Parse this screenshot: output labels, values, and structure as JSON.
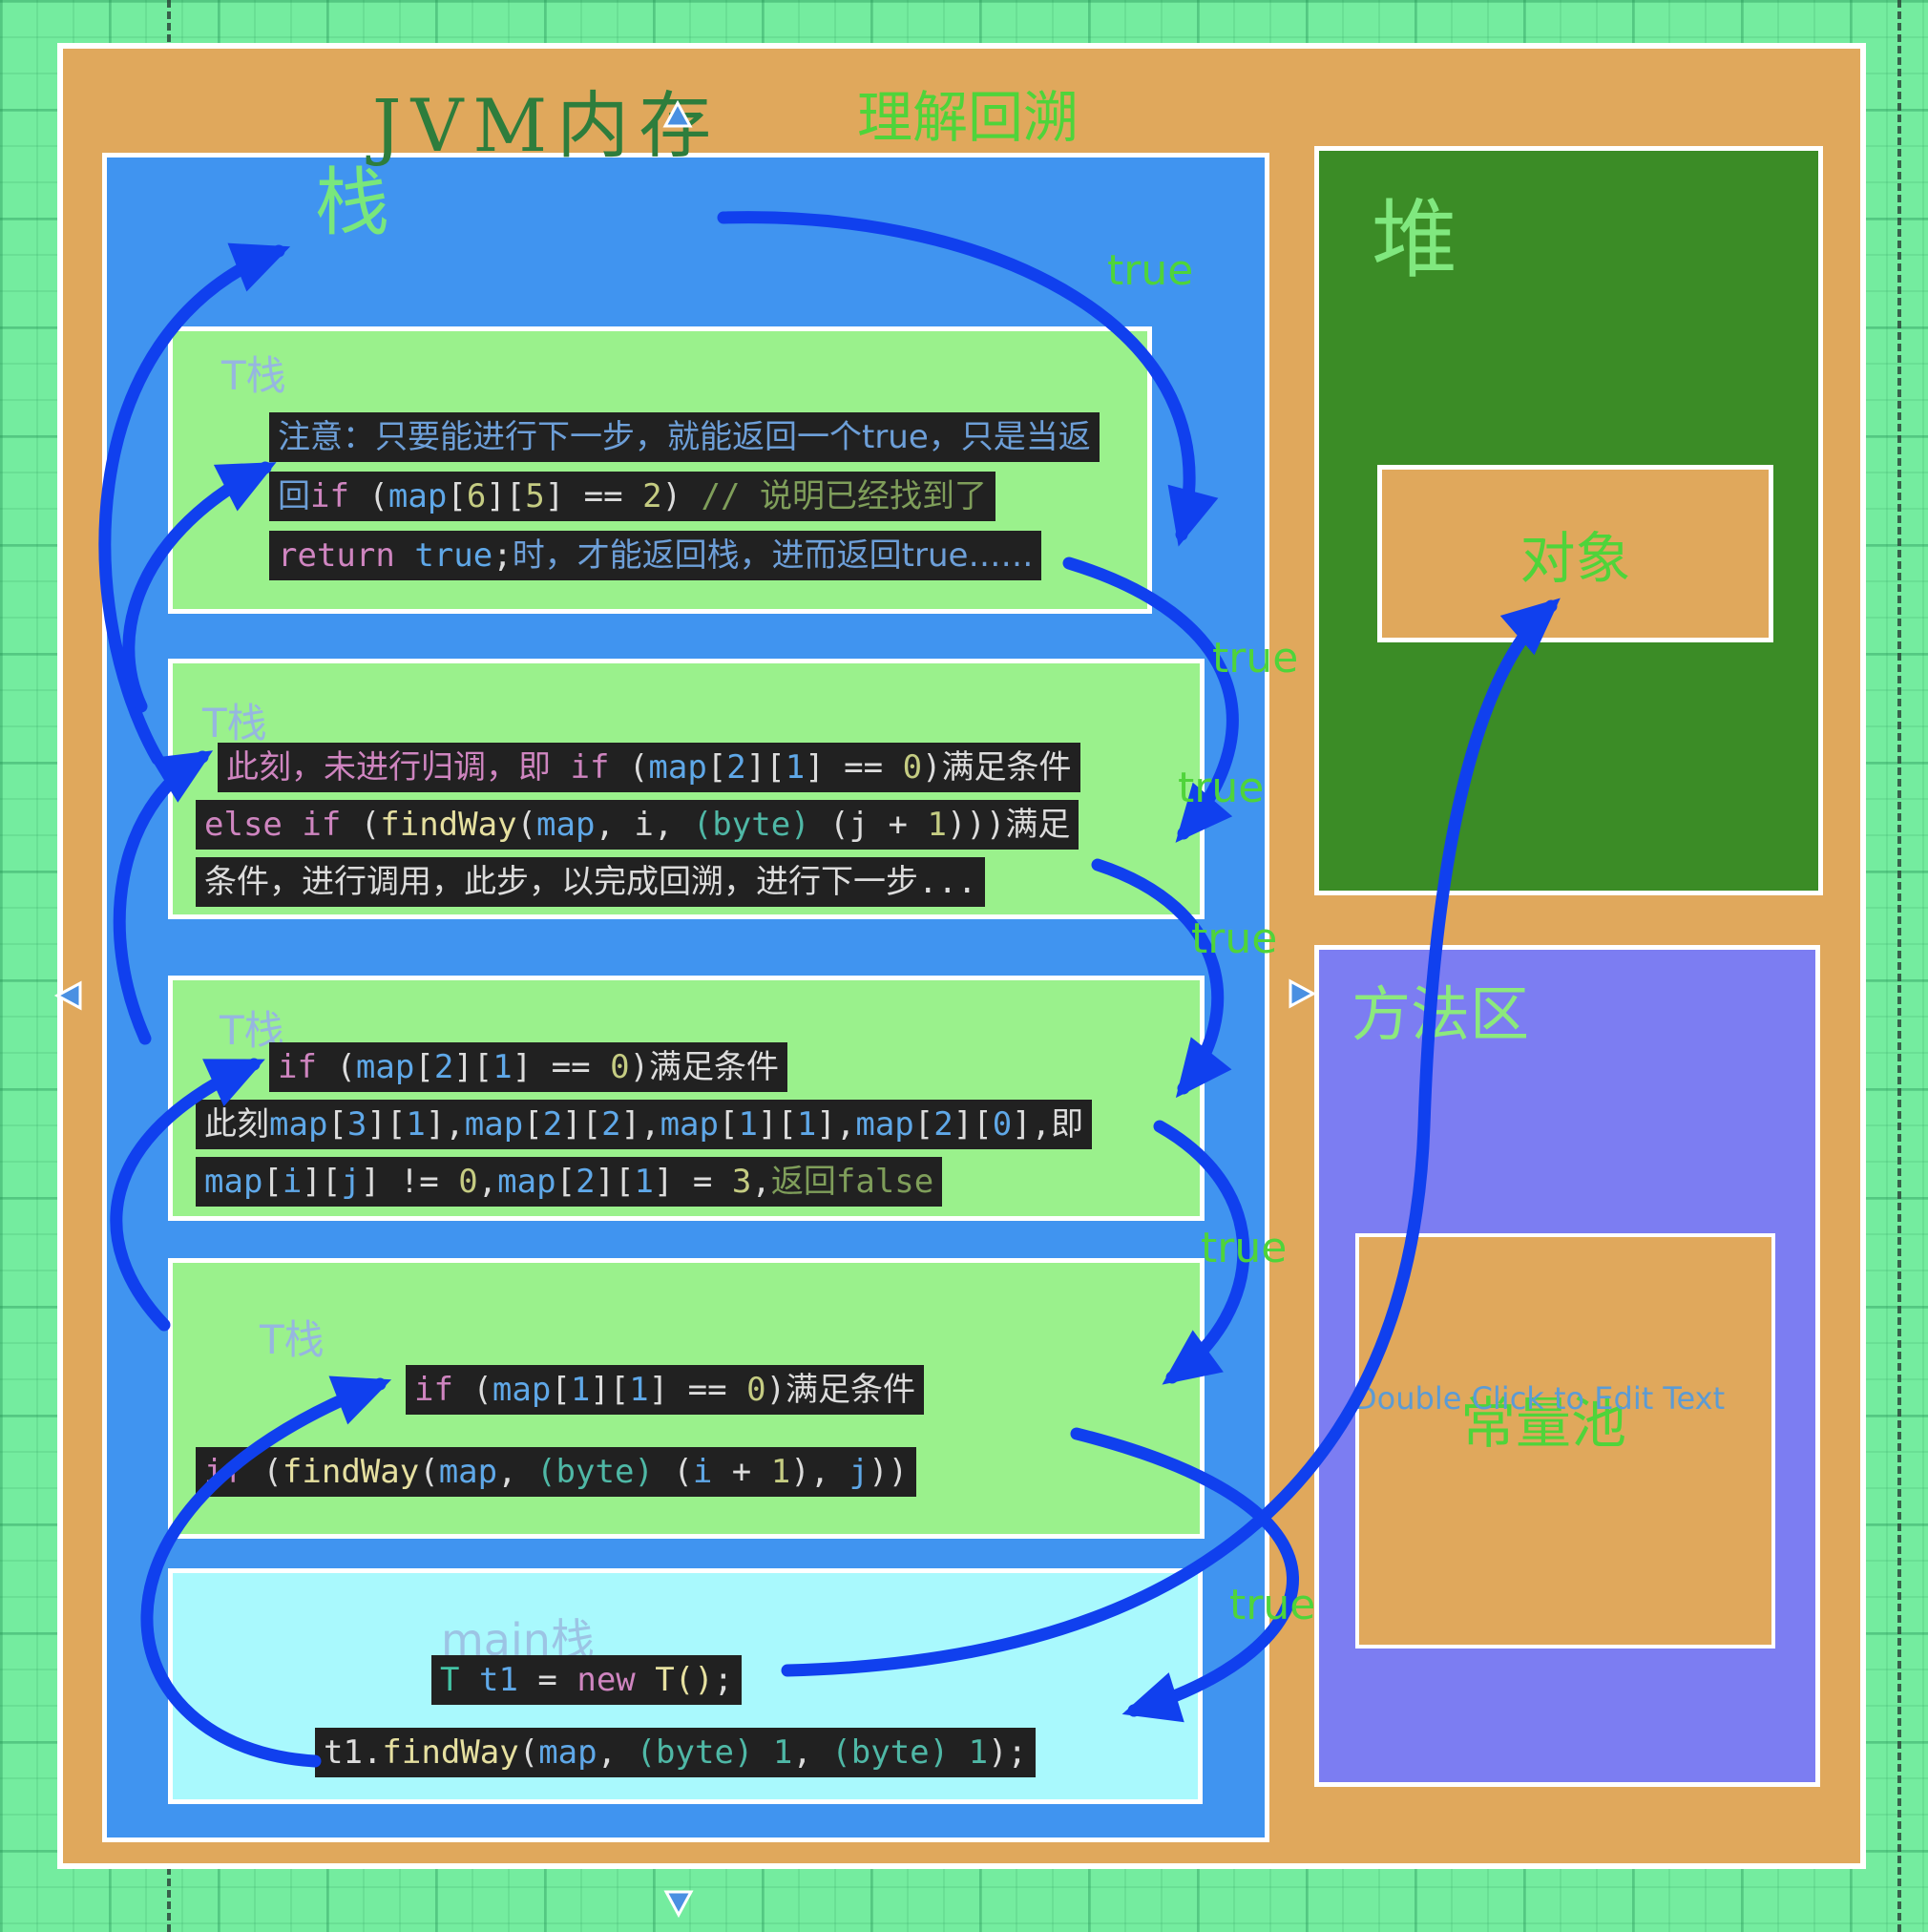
{
  "title": {
    "main": "JVM内存",
    "subtitle": "理解回溯"
  },
  "stack": {
    "label": "栈",
    "frames": [
      {
        "label": "T栈",
        "lines": [
          [
            {
              "t": "zh",
              "s": "注意：只要能进行下一步，就能返回一个true，只是当返"
            }
          ],
          [
            {
              "t": "zh",
              "s": "回"
            },
            {
              "t": "kw",
              "s": "if"
            },
            {
              "t": "pl",
              "s": " ("
            },
            {
              "t": "id",
              "s": "map"
            },
            {
              "t": "pl",
              "s": "["
            },
            {
              "t": "num",
              "s": "6"
            },
            {
              "t": "pl",
              "s": "]["
            },
            {
              "t": "num",
              "s": "5"
            },
            {
              "t": "pl",
              "s": "] == "
            },
            {
              "t": "num",
              "s": "2"
            },
            {
              "t": "pl",
              "s": ") "
            },
            {
              "t": "com",
              "s": "// 说明已经找到了"
            }
          ],
          [
            {
              "t": "kw",
              "s": "return"
            },
            {
              "t": "pl",
              "s": " "
            },
            {
              "t": "id",
              "s": "true"
            },
            {
              "t": "pl",
              "s": ";"
            },
            {
              "t": "zh",
              "s": "时，才能返回栈，进而返回true……"
            }
          ]
        ]
      },
      {
        "label": "T栈",
        "lines": [
          [
            {
              "t": "kw",
              "s": "此刻，未进行归调，即 if"
            },
            {
              "t": "pl",
              "s": " ("
            },
            {
              "t": "id",
              "s": "map"
            },
            {
              "t": "pl",
              "s": "["
            },
            {
              "t": "id",
              "s": "2"
            },
            {
              "t": "pl",
              "s": "]["
            },
            {
              "t": "id",
              "s": "1"
            },
            {
              "t": "pl",
              "s": "] == "
            },
            {
              "t": "num",
              "s": "0"
            },
            {
              "t": "pl",
              "s": ")满足条件"
            }
          ],
          [
            {
              "t": "kw",
              "s": "else if"
            },
            {
              "t": "pl",
              "s": " ("
            },
            {
              "t": "fn",
              "s": "findWay"
            },
            {
              "t": "pl",
              "s": "("
            },
            {
              "t": "id",
              "s": "map"
            },
            {
              "t": "pl",
              "s": ", i, "
            },
            {
              "t": "byte",
              "s": "(byte)"
            },
            {
              "t": "pl",
              "s": " (j + "
            },
            {
              "t": "num",
              "s": "1"
            },
            {
              "t": "pl",
              "s": ")))满足"
            }
          ],
          [
            {
              "t": "pl",
              "s": "条件，进行调用，此步，以完成回溯，进行下一步..."
            }
          ]
        ]
      },
      {
        "label": "T栈",
        "lines": [
          [
            {
              "t": "kw",
              "s": "if"
            },
            {
              "t": "pl",
              "s": " ("
            },
            {
              "t": "id",
              "s": "map"
            },
            {
              "t": "pl",
              "s": "["
            },
            {
              "t": "id",
              "s": "2"
            },
            {
              "t": "pl",
              "s": "]["
            },
            {
              "t": "id",
              "s": "1"
            },
            {
              "t": "pl",
              "s": "] == "
            },
            {
              "t": "num",
              "s": "0"
            },
            {
              "t": "pl",
              "s": ")满足条件"
            }
          ],
          [
            {
              "t": "pl",
              "s": "此刻"
            },
            {
              "t": "id",
              "s": "map"
            },
            {
              "t": "pl",
              "s": "["
            },
            {
              "t": "id",
              "s": "3"
            },
            {
              "t": "pl",
              "s": "]["
            },
            {
              "t": "id",
              "s": "1"
            },
            {
              "t": "pl",
              "s": "],"
            },
            {
              "t": "id",
              "s": "map"
            },
            {
              "t": "pl",
              "s": "["
            },
            {
              "t": "id",
              "s": "2"
            },
            {
              "t": "pl",
              "s": "]["
            },
            {
              "t": "id",
              "s": "2"
            },
            {
              "t": "pl",
              "s": "],"
            },
            {
              "t": "id",
              "s": "map"
            },
            {
              "t": "pl",
              "s": "["
            },
            {
              "t": "id",
              "s": "1"
            },
            {
              "t": "pl",
              "s": "]["
            },
            {
              "t": "id",
              "s": "1"
            },
            {
              "t": "pl",
              "s": "],"
            },
            {
              "t": "id",
              "s": "map"
            },
            {
              "t": "pl",
              "s": "["
            },
            {
              "t": "id",
              "s": "2"
            },
            {
              "t": "pl",
              "s": "]["
            },
            {
              "t": "id",
              "s": "0"
            },
            {
              "t": "pl",
              "s": "],即"
            }
          ],
          [
            {
              "t": "id",
              "s": "map"
            },
            {
              "t": "pl",
              "s": "["
            },
            {
              "t": "id",
              "s": "i"
            },
            {
              "t": "pl",
              "s": "]["
            },
            {
              "t": "id",
              "s": "j"
            },
            {
              "t": "pl",
              "s": "] != "
            },
            {
              "t": "num",
              "s": "0"
            },
            {
              "t": "pl",
              "s": ","
            },
            {
              "t": "id",
              "s": "map"
            },
            {
              "t": "pl",
              "s": "["
            },
            {
              "t": "id",
              "s": "2"
            },
            {
              "t": "pl",
              "s": "]["
            },
            {
              "t": "id",
              "s": "1"
            },
            {
              "t": "pl",
              "s": "] = "
            },
            {
              "t": "num",
              "s": "3"
            },
            {
              "t": "pl",
              "s": ","
            },
            {
              "t": "com",
              "s": "返回false"
            }
          ]
        ]
      },
      {
        "label": "T栈",
        "lines": [
          [
            {
              "t": "kw",
              "s": "if"
            },
            {
              "t": "pl",
              "s": " ("
            },
            {
              "t": "id",
              "s": "map"
            },
            {
              "t": "pl",
              "s": "["
            },
            {
              "t": "id",
              "s": "1"
            },
            {
              "t": "pl",
              "s": "]["
            },
            {
              "t": "id",
              "s": "1"
            },
            {
              "t": "pl",
              "s": "] == "
            },
            {
              "t": "num",
              "s": "0"
            },
            {
              "t": "pl",
              "s": ")满足条件"
            }
          ],
          [
            {
              "t": "kw",
              "s": "if"
            },
            {
              "t": "pl",
              "s": " ("
            },
            {
              "t": "fn",
              "s": "findWay"
            },
            {
              "t": "pl",
              "s": "("
            },
            {
              "t": "id",
              "s": "map"
            },
            {
              "t": "pl",
              "s": ", "
            },
            {
              "t": "byte",
              "s": "(byte)"
            },
            {
              "t": "pl",
              "s": " ("
            },
            {
              "t": "id",
              "s": "i"
            },
            {
              "t": "pl",
              "s": " + "
            },
            {
              "t": "num",
              "s": "1"
            },
            {
              "t": "pl",
              "s": "), "
            },
            {
              "t": "id",
              "s": "j"
            },
            {
              "t": "pl",
              "s": "))"
            }
          ]
        ]
      }
    ],
    "main_frame": {
      "label": "main栈",
      "lines": [
        [
          {
            "t": "cls",
            "s": "T"
          },
          {
            "t": "pl",
            "s": " "
          },
          {
            "t": "id",
            "s": "t1"
          },
          {
            "t": "pl",
            "s": " = "
          },
          {
            "t": "kw",
            "s": "new"
          },
          {
            "t": "pl",
            "s": " "
          },
          {
            "t": "fn",
            "s": "T()"
          },
          {
            "t": "pl",
            "s": ";"
          }
        ],
        [
          {
            "t": "pl",
            "s": "t1."
          },
          {
            "t": "fn",
            "s": "findWay"
          },
          {
            "t": "pl",
            "s": "("
          },
          {
            "t": "id",
            "s": "map"
          },
          {
            "t": "pl",
            "s": ", "
          },
          {
            "t": "byte",
            "s": "(byte) 1"
          },
          {
            "t": "pl",
            "s": ", "
          },
          {
            "t": "byte",
            "s": "(byte) 1"
          },
          {
            "t": "pl",
            "s": ");"
          }
        ]
      ]
    }
  },
  "heap": {
    "label": "堆",
    "object_label": "对象"
  },
  "method_area": {
    "label": "方法区",
    "constant_pool_label": "常量池",
    "placeholder": "Double Click to Edit Text"
  },
  "arrow_labels": {
    "t1": "true",
    "t2": "true",
    "t3": "true",
    "t4": "true",
    "t5": "true",
    "t6": "true"
  },
  "colors": {
    "arrow": "#1040ee",
    "true_label": "#4fd43a",
    "stack_fill": "#4094f0",
    "frame_fill": "#9af18c",
    "main_frame_fill": "#a9f9fd",
    "heap_fill": "#3b8c26",
    "method_fill": "#7c7df2",
    "container_fill": "#e0a85c",
    "code_bg": "#212121"
  }
}
